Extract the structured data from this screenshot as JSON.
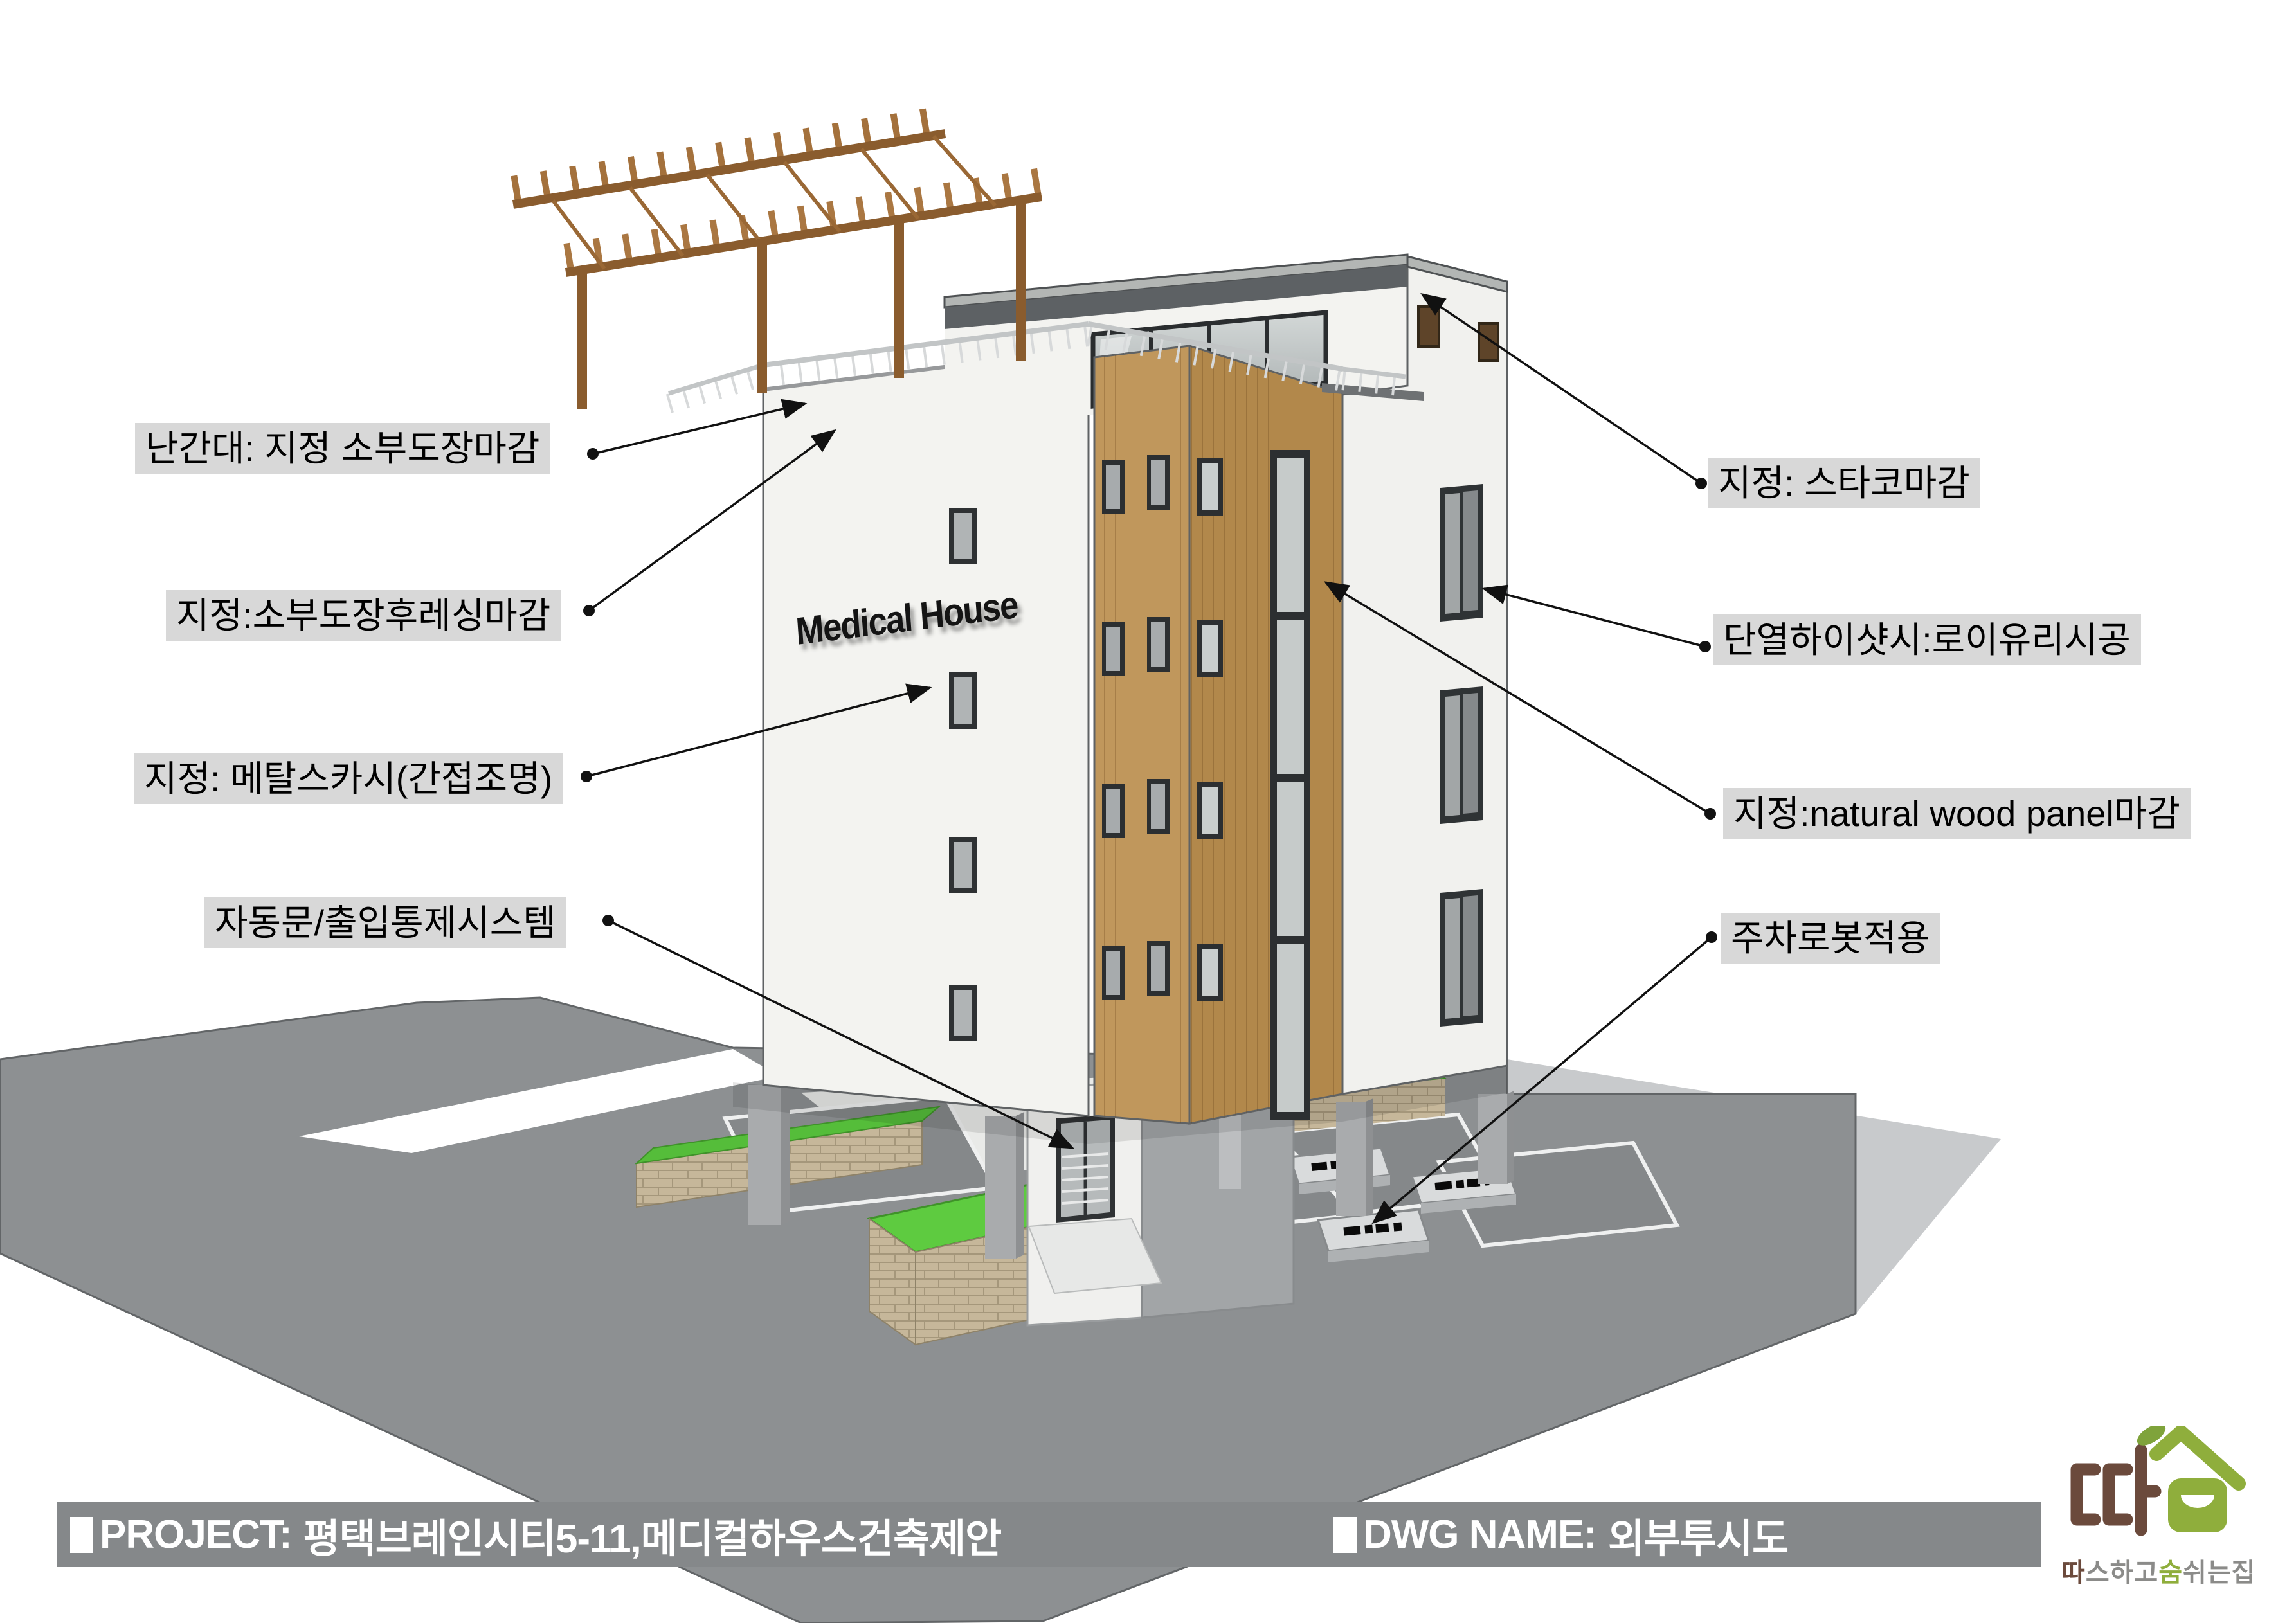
{
  "page": {
    "background": "#ffffff"
  },
  "annotations": {
    "bg_color": "#d8d8d8",
    "text_color": "#000000",
    "left": [
      {
        "text": "난간대: 지정 소부도장마감"
      },
      {
        "text": "지정:소부도장후레싱마감"
      },
      {
        "text": "지정: 메탈스카시(간접조명)"
      },
      {
        "text": "자동문/출입통제시스템"
      }
    ],
    "right": [
      {
        "text": "지정: 스타코마감"
      },
      {
        "text": "단열하이샷시:로이유리시공"
      },
      {
        "text": "지정:natural wood panel마감"
      },
      {
        "text": "주차로봇적용"
      }
    ]
  },
  "building": {
    "sign_text": "Medical House"
  },
  "footer": {
    "bar_color": "#85888a",
    "project_label": "PROJECT:",
    "project_value": "평택브레인시티5-11,메디컬하우스건축제안",
    "dwg_label": "DWG NAME:",
    "dwg_value": "외부투시도"
  },
  "logo": {
    "brand_brown": "#6b4a3c",
    "brand_green": "#8fae3c",
    "tagline_parts": [
      {
        "text": "따",
        "color": "#6b4a3c"
      },
      {
        "text": "스하고",
        "color": "#8b8b89"
      },
      {
        "text": "숨",
        "color": "#8fae3c"
      },
      {
        "text": "쉬는집",
        "color": "#8b8b89"
      }
    ]
  }
}
